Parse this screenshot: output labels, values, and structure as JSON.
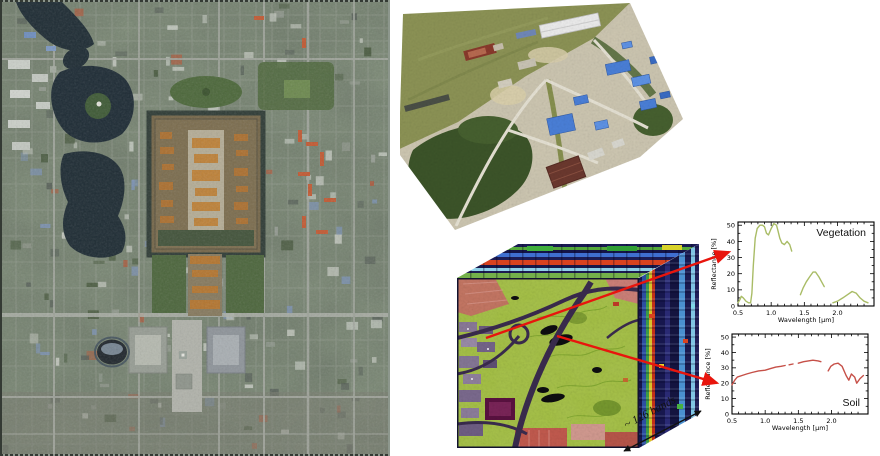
{
  "figure": {
    "bands_label": "~ 126 bands"
  },
  "colors": {
    "arrow": "#e8150d",
    "vegetation_curve": "#a9bc66",
    "soil_curve": "#c65048"
  },
  "chart_data": [
    {
      "type": "line",
      "title": "Vegetation",
      "title_pos": "top-right",
      "xlabel": "Wavelength [µm]",
      "ylabel": "Reflectance [%]",
      "xlim": [
        0.5,
        2.55
      ],
      "ylim": [
        0,
        52
      ],
      "xticks": [
        0.5,
        1.0,
        1.5,
        2.0
      ],
      "yticks": [
        0,
        10,
        20,
        30,
        40,
        50
      ],
      "minor": {
        "x": 0.1,
        "y": 5
      },
      "grid": false,
      "legend": "none",
      "series": [
        {
          "name": "Vegetation",
          "color": "#a9bc66",
          "segments": [
            [
              [
                0.5,
                2
              ],
              [
                0.53,
                4
              ],
              [
                0.55,
                6
              ],
              [
                0.58,
                5
              ],
              [
                0.62,
                3
              ],
              [
                0.66,
                2
              ],
              [
                0.69,
                2
              ],
              [
                0.71,
                8
              ],
              [
                0.73,
                25
              ],
              [
                0.76,
                42
              ],
              [
                0.79,
                48
              ],
              [
                0.83,
                50
              ],
              [
                0.87,
                50
              ],
              [
                0.9,
                49
              ],
              [
                0.93,
                45
              ],
              [
                0.96,
                44
              ],
              [
                1.0,
                48
              ],
              [
                1.04,
                51
              ],
              [
                1.08,
                50
              ],
              [
                1.1,
                47
              ],
              [
                1.13,
                42
              ],
              [
                1.16,
                39
              ],
              [
                1.2,
                38
              ],
              [
                1.24,
                40
              ],
              [
                1.28,
                38
              ],
              [
                1.31,
                34
              ]
            ],
            [
              [
                1.44,
                7
              ],
              [
                1.48,
                11
              ],
              [
                1.53,
                15
              ],
              [
                1.58,
                18
              ],
              [
                1.63,
                21
              ],
              [
                1.67,
                21
              ],
              [
                1.72,
                18
              ],
              [
                1.76,
                15
              ],
              [
                1.8,
                12
              ]
            ],
            [
              [
                1.93,
                2
              ],
              [
                2.0,
                3
              ],
              [
                2.08,
                5
              ],
              [
                2.15,
                7
              ],
              [
                2.22,
                9
              ],
              [
                2.28,
                8
              ],
              [
                2.34,
                5
              ],
              [
                2.4,
                3
              ],
              [
                2.46,
                2
              ]
            ]
          ]
        }
      ]
    },
    {
      "type": "line",
      "title": "Soil",
      "title_pos": "bottom-right",
      "xlabel": "Wavelength [µm]",
      "ylabel": "Reflectance [%]",
      "xlim": [
        0.5,
        2.55
      ],
      "ylim": [
        0,
        52
      ],
      "xticks": [
        0.5,
        1.0,
        1.5,
        2.0
      ],
      "yticks": [
        0,
        10,
        20,
        30,
        40,
        50
      ],
      "minor": {
        "x": 0.1,
        "y": 5
      },
      "grid": false,
      "legend": "none",
      "series": [
        {
          "name": "Soil",
          "color": "#c65048",
          "segments": [
            [
              [
                0.5,
                19
              ],
              [
                0.54,
                22
              ],
              [
                0.58,
                24
              ],
              [
                0.65,
                25
              ],
              [
                0.72,
                26
              ],
              [
                0.8,
                27
              ],
              [
                0.9,
                28
              ],
              [
                1.0,
                28.5
              ],
              [
                1.08,
                29.5
              ],
              [
                1.16,
                30.5
              ],
              [
                1.24,
                31
              ],
              [
                1.3,
                31.5
              ]
            ],
            [
              [
                1.36,
                32
              ],
              [
                1.42,
                32.5
              ]
            ],
            [
              [
                1.5,
                33
              ],
              [
                1.58,
                34
              ],
              [
                1.65,
                34.5
              ],
              [
                1.72,
                35
              ],
              [
                1.8,
                34.5
              ],
              [
                1.84,
                34
              ]
            ],
            [
              [
                1.95,
                28
              ],
              [
                1.99,
                31
              ],
              [
                2.04,
                32.5
              ],
              [
                2.1,
                33
              ],
              [
                2.16,
                31
              ],
              [
                2.22,
                25
              ],
              [
                2.26,
                22
              ],
              [
                2.3,
                26
              ],
              [
                2.35,
                24
              ],
              [
                2.38,
                20
              ],
              [
                2.43,
                23
              ],
              [
                2.48,
                25
              ]
            ]
          ]
        }
      ]
    }
  ]
}
